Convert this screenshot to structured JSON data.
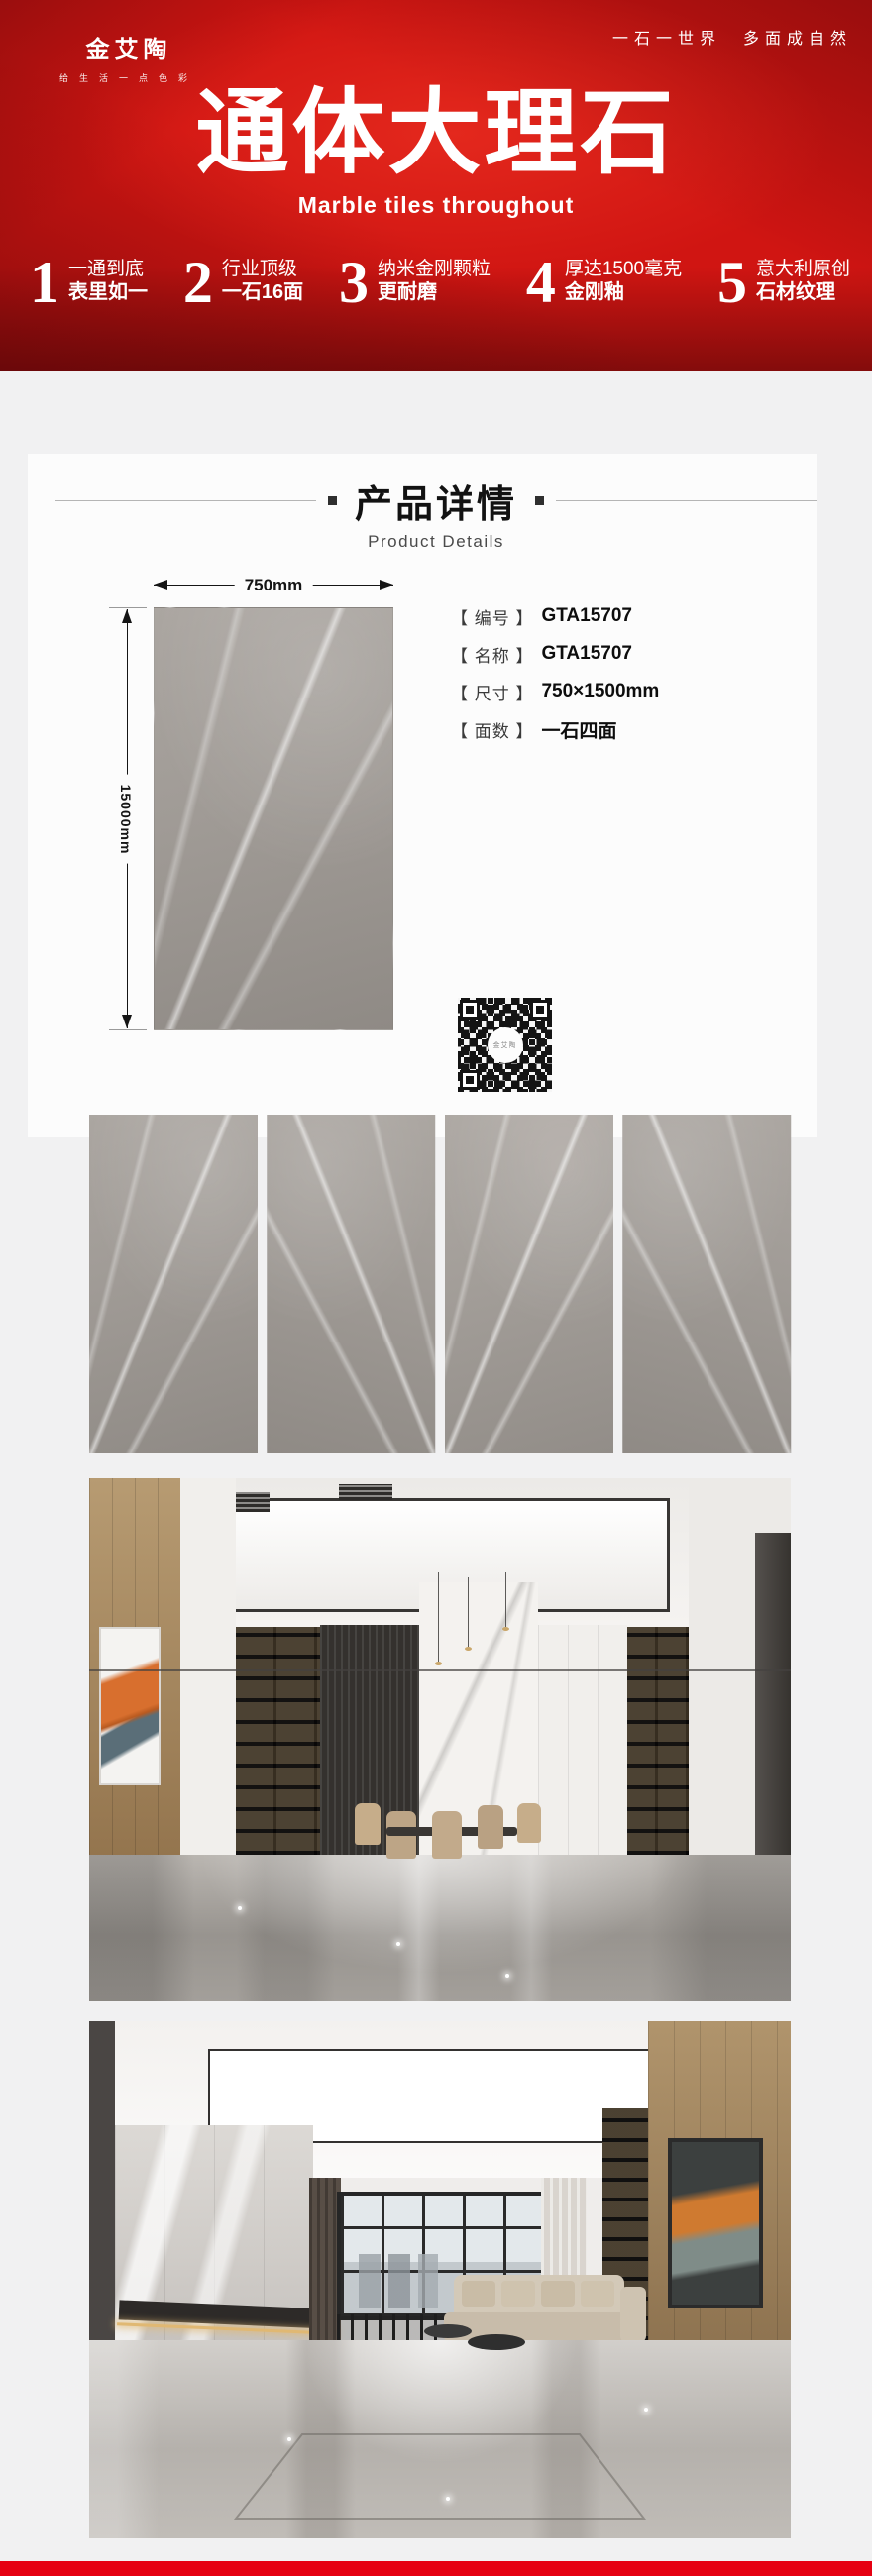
{
  "header": {
    "logo": "金艾陶",
    "logo_tagline": "给生活一点色彩",
    "slogan": "一石一世界　多面成自然",
    "title": "通体大理石",
    "subtitle": "Marble tiles throughout",
    "features": [
      {
        "num": "1",
        "line1": "一通到底",
        "line2": "表里如一"
      },
      {
        "num": "2",
        "line1": "行业顶级",
        "line2": "一石16面"
      },
      {
        "num": "3",
        "line1": "纳米金刚颗粒",
        "line2": "更耐磨"
      },
      {
        "num": "4",
        "line1": "厚达1500毫克",
        "line2": "金刚釉"
      },
      {
        "num": "5",
        "line1": "意大利原创",
        "line2": "石材纹理"
      }
    ]
  },
  "details": {
    "section_title": "产品详情",
    "section_subtitle": "Product Details",
    "dim_width": "750mm",
    "dim_height": "15000mm",
    "specs": [
      {
        "label": "【 编号 】",
        "value": "GTA15707"
      },
      {
        "label": "【 名称 】",
        "value": "GTA15707"
      },
      {
        "label": "【 尺寸 】",
        "value": "750×1500mm"
      },
      {
        "label": "【 面数 】",
        "value": "一石四面"
      }
    ],
    "qr_label": "金艾陶"
  },
  "colors": {
    "brand_red": "#d01512",
    "footer_red": "#e60012",
    "page_bg": "#f1f1f2",
    "tile_gray": "#a09b96"
  }
}
